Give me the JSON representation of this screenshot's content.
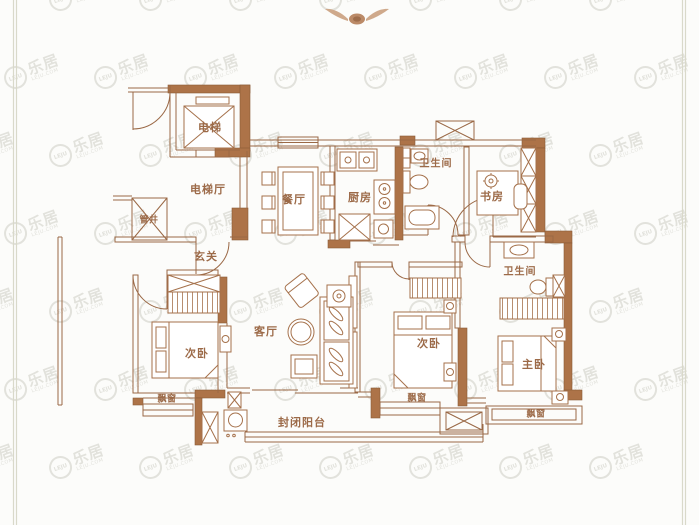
{
  "watermark": {
    "brand_cn": "乐居",
    "brand_en": "LEJU",
    "brand_sub": "LEJU.COM"
  },
  "palette": {
    "wall_fill": "#ad7348",
    "wall_edge": "#8a5a38",
    "line": "#9a6845",
    "furniture_line": "#a5714b",
    "label_text": "#9c6a48",
    "page_border": "#d9d9ca",
    "background": "#fcfcfa"
  },
  "compass": {
    "icon": "winged-emblem"
  },
  "rooms": {
    "elevator": "电梯",
    "elevator_hall": "电梯厅",
    "pipe_shaft": "管井",
    "entrance": "玄关",
    "dining": "餐厅",
    "kitchen": "厨房",
    "bathroom_1": "卫生间",
    "study": "书房",
    "bathroom_2": "卫生间",
    "living": "客厅",
    "bedroom_left": "次卧",
    "bedroom_middle": "次卧",
    "master_bedroom": "主卧",
    "balcony": "封闭阳台",
    "bay_window_left": "飘窗",
    "bay_window_middle": "飘窗",
    "bay_window_right": "飘窗"
  }
}
